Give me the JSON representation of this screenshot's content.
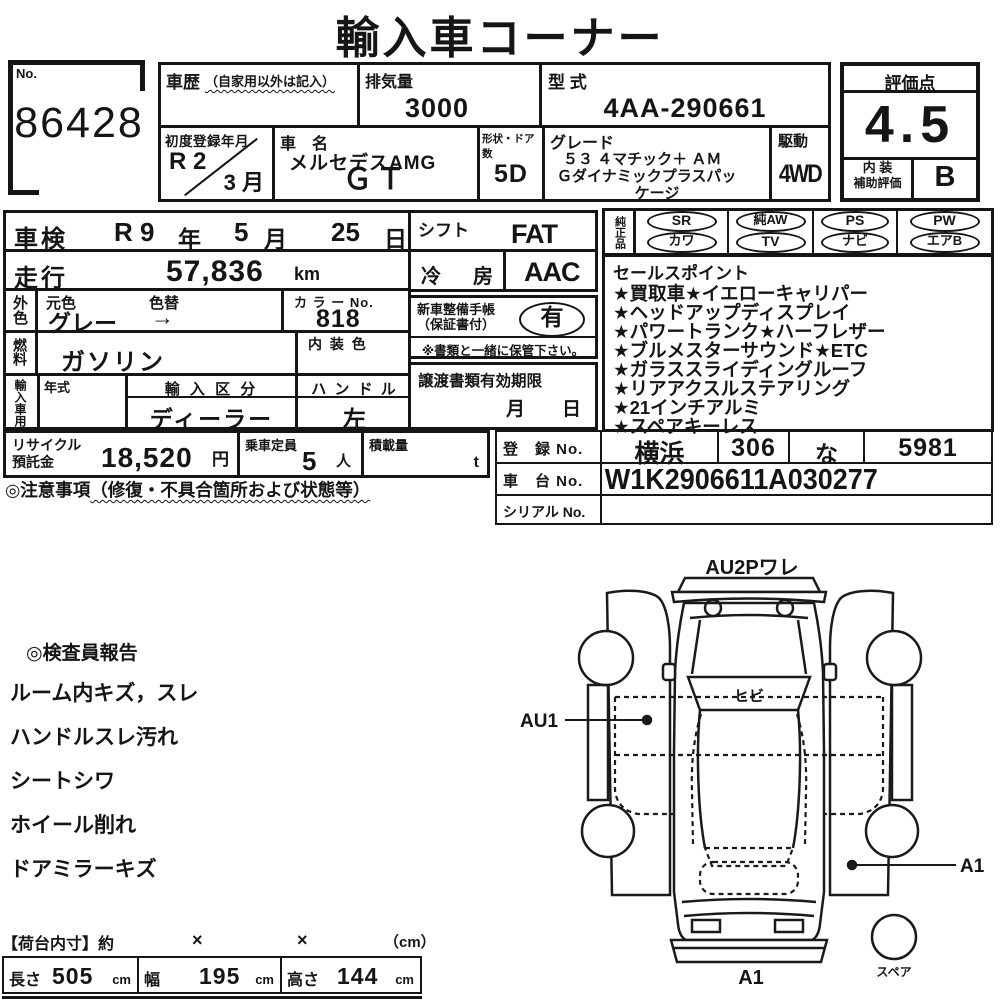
{
  "title": "輸入車コーナー",
  "no_box": {
    "label": "No.",
    "value": "86428"
  },
  "history": {
    "label": "車歴",
    "note": "（自家用以外は記入）",
    "value": ""
  },
  "displacement": {
    "label": "排気量",
    "value": "3000"
  },
  "model_code": {
    "label": "型 式",
    "value": "4AA-290661"
  },
  "first_reg": {
    "label": "初度登録年月",
    "era": "R 2",
    "month": "3 月"
  },
  "car_name": {
    "label": "車　名",
    "line1": "メルセデスAMG",
    "line2": "ＧＴ"
  },
  "doors": {
    "label": "形状・ドア数",
    "value": "5D"
  },
  "grade": {
    "label": "グレード",
    "line1": "５３ ４マチック＋ ＡＭ",
    "line2": "Ｇダイナミックプラスパッ",
    "line3": "ケージ"
  },
  "drive": {
    "label": "駆動",
    "value": "4WD"
  },
  "score": {
    "label": "評価点",
    "value": "4.5",
    "interior_label1": "内 装",
    "interior_label2": "補助評価",
    "interior_value": "B"
  },
  "shaken": {
    "label": "車検",
    "era": "R 9",
    "year_unit": "年",
    "month": "5",
    "month_unit": "月",
    "day": "25",
    "day_unit": "日"
  },
  "mileage": {
    "label": "走行",
    "value": "57,836",
    "unit": "km"
  },
  "exterior": {
    "label": "外色",
    "moto_label": "元色",
    "kae_label": "色替",
    "value": "グレー",
    "arrow": "→",
    "color_no_label": "カ ラ ー No.",
    "color_no": "818"
  },
  "fuel": {
    "label": "燃料",
    "value": "ガソリン",
    "interior_color_label": "内 装 色",
    "interior_color": ""
  },
  "import_use": {
    "label": "輸入車用",
    "year_label": "年式",
    "year": "",
    "division_label": "輸 入 区 分",
    "division": "ディーラー",
    "handle_label": "ハ ン ド ル",
    "handle": "左"
  },
  "shift": {
    "label": "シフト",
    "value": "FAT"
  },
  "ac": {
    "label": "冷　房",
    "value": "AAC"
  },
  "service_book": {
    "label1": "新車整備手帳",
    "label2": "（保証書付）",
    "value": "有",
    "note": "※書類と一緒に保管下さい。"
  },
  "transfer_docs": {
    "label": "譲渡書類有効期限",
    "month_unit": "月",
    "day_unit": "日"
  },
  "genuine": {
    "label": "純正品",
    "row1": [
      "SR",
      "純AW",
      "PS",
      "PW"
    ],
    "row2": [
      "カワ",
      "TV",
      "ナビ",
      "エアB"
    ]
  },
  "sales_points": {
    "label": "セールスポイント",
    "items": [
      "★買取車★イエローキャリパー",
      "★ヘッドアップディスプレイ",
      "★パワートランク★ハーフレザー",
      "★ブルメスターサウンド★ETC",
      "★ガラススライディングルーフ",
      "★リアアクスルステアリング",
      "★21インチアルミ",
      "★スペアキーレス"
    ]
  },
  "recycle": {
    "label1": "リサイクル",
    "label2": "預託金",
    "value": "18,520",
    "unit": "円"
  },
  "capacity": {
    "label": "乗車定員",
    "value": "5",
    "unit": "人"
  },
  "load": {
    "label": "積載量",
    "value": "",
    "unit": "t"
  },
  "notes": {
    "label": "◎注意事項",
    "sub": "（修復・不具合箇所および状態等）"
  },
  "registration": {
    "reg_label": "登　録 No.",
    "reg_values": [
      "横浜",
      "306",
      "な",
      "5981"
    ],
    "chassis_label": "車　台 No.",
    "chassis_value": "W1K2906611A030277",
    "serial_label": "シリアル No.",
    "serial_value": ""
  },
  "inspector": {
    "label": "◎検査員報告",
    "items": [
      "ルーム内キズ，スレ",
      "ハンドルスレ汚れ",
      "シートシワ",
      "ホイール削れ",
      "ドアミラーキズ"
    ]
  },
  "diagram": {
    "top_label": "AU2Pワレ",
    "windshield_label": "ヒビ",
    "left_label": "AU1",
    "right_label": "A1",
    "bottom_label": "A1",
    "spare_label": "スペア"
  },
  "cargo": {
    "header": "【荷台内寸】約",
    "times1": "×",
    "times2": "×",
    "unit": "（cm）",
    "length_label": "長さ",
    "length": "505",
    "length_unit": "cm",
    "width_label": "幅",
    "width": "195",
    "width_unit": "cm",
    "height_label": "高さ",
    "height": "144",
    "height_unit": "cm"
  }
}
